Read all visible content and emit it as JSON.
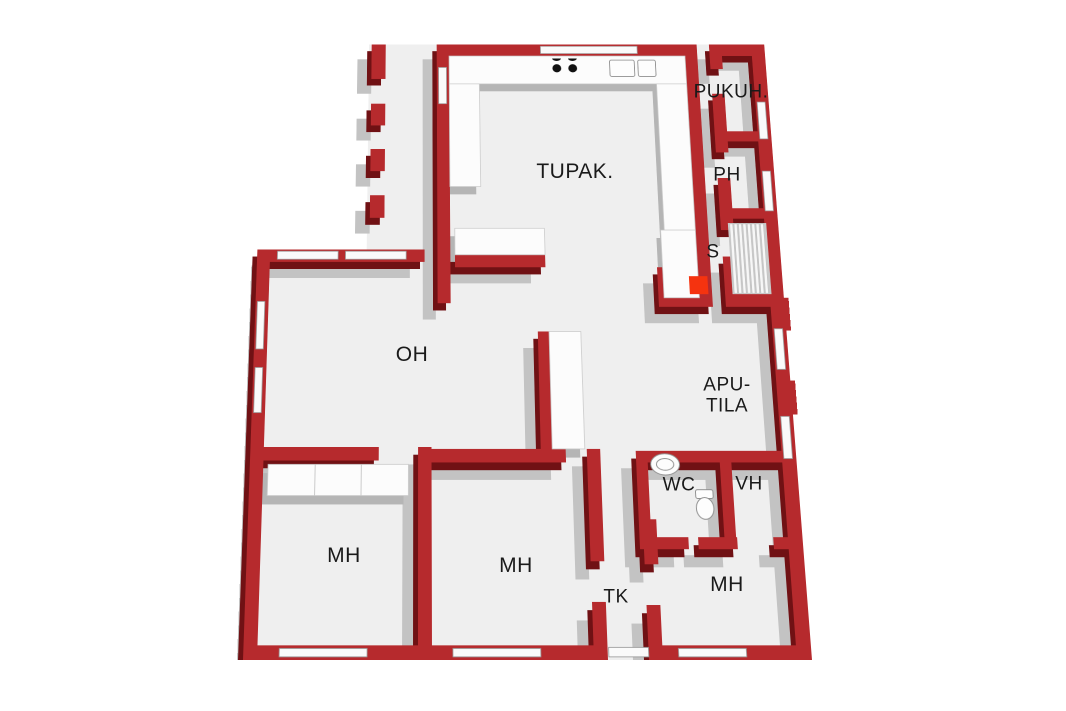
{
  "title": "3D floor plan",
  "rooms": [
    {
      "id": "tupak",
      "label": "TUPAK."
    },
    {
      "id": "pukuh",
      "label": "PUKUH."
    },
    {
      "id": "ph",
      "label": "PH"
    },
    {
      "id": "s",
      "label": "S"
    },
    {
      "id": "oh",
      "label": "OH"
    },
    {
      "id": "apu_tila",
      "label": "APU-TILA"
    },
    {
      "id": "wc",
      "label": "WC"
    },
    {
      "id": "vh",
      "label": "VH"
    },
    {
      "id": "mh_left",
      "label": "MH"
    },
    {
      "id": "mh_middle",
      "label": "MH"
    },
    {
      "id": "tk",
      "label": "TK"
    },
    {
      "id": "mh_right",
      "label": "MH"
    }
  ],
  "fixtures": [
    "kitchen-u-counter",
    "stove-burners",
    "kitchen-sink",
    "tall-cabinet",
    "sauna-benches",
    "sauna-stove",
    "wc-sink",
    "wc-toilet",
    "bedroom-wardrobe",
    "hall-cabinet",
    "terrace-posts",
    "windows",
    "door-openings",
    "entry-threshold"
  ],
  "colors": {
    "background": "#ffffff",
    "floor": "#efefef",
    "wall_top": "#b62a2d",
    "wall_side": "#701114",
    "wall_shadow": "#c3c3c3",
    "window": "#fafafa",
    "furniture_top": "#fcfcfc",
    "furniture_side": "#b5b5b5",
    "sauna_stove": "#f5330f",
    "burner_black": "#111111",
    "label_text": "#1a1a1a"
  }
}
